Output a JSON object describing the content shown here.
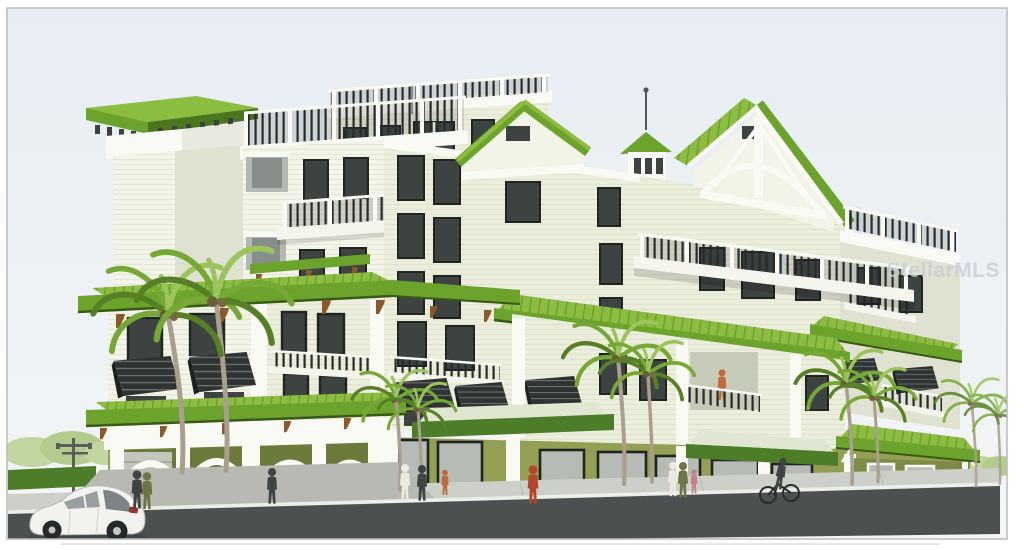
{
  "meta": {
    "type": "architectural-rendering",
    "subject": "Multi-story coastal condominium building with green metal roofs, cream siding and olive-green ground floor",
    "setting": "Street-corner view with palm trees, pedestrians, a cyclist, parked white hatchback and storefront arcade"
  },
  "watermark": {
    "text": "StellarMLS"
  },
  "palette": {
    "paper": "#ffffff",
    "border": "#b7bbbe",
    "sky_top": "#e7edf3",
    "sky_bottom": "#f4f6f7",
    "roof_light": "#8cbd41",
    "roof_mid": "#6ba32c",
    "roof_dark": "#4c761d",
    "roof_edge": "#3a5a15",
    "wall_cream": "#f3f4e8",
    "wall_cream2": "#eceedc",
    "wall_shade": "#dfe2d0",
    "trim_white": "#fafaf4",
    "olive": "#93a054",
    "olive_shade": "#7d8b46",
    "olive_dark": "#6c7a3c",
    "glass": "#3d4341",
    "glass_light": "#b7bbb5",
    "frame": "#202522",
    "rail_dark": "#272b2a",
    "slab": "#f5f5ee",
    "bracket": "#8a5a2a",
    "trunk": "#a89f8d",
    "frond": "#76a836",
    "frond_dark": "#577f26",
    "frond_light": "#9cc45d",
    "bed": "#5c8530",
    "flower": "#ddb043",
    "hedge": "#4e7d2a",
    "bgtree": "#c2d6a0",
    "road": "#4d5051",
    "sidewalk": "#cdd0c8",
    "curb": "#eceee8",
    "drive": "#b7b9b2",
    "car_white": "#f2f2ef",
    "car_shade": "#b9bcb6",
    "car_glass": "#9aa0a2",
    "car_glass_dark": "#7e8486",
    "wheel": "#26292a",
    "hub": "#c5c8c4",
    "tail": "#93342f",
    "blur_car": "#8f9494",
    "canopy_dark": "#4e7d2a",
    "canopy_sheen": "#dfe7d2",
    "watermark": "#c9ced4",
    "fig_red": "#b5452c",
    "fig_olive": "#6d7446",
    "fig_dark": "#3f4440",
    "fig_white": "#eceae2",
    "fig_pink": "#c77f8a",
    "fig_blue": "#dce4ea",
    "fig_orange": "#c06a38",
    "pole": "#5a5d5a"
  },
  "scene": {
    "objects": [
      "sky",
      "elevator-tower",
      "penthouse-roof-deck",
      "center-block",
      "left-gable",
      "cupola",
      "right-gable",
      "roof-terrace",
      "long-balcony",
      "main-green-roof",
      "right-wing",
      "left-wing",
      "ground-arcade",
      "storefronts",
      "pavilion",
      "palm-trees",
      "landscaping",
      "street-light",
      "sidewalk",
      "road",
      "white-hatchback-car",
      "parked-gray-cars",
      "pedestrians",
      "cyclist",
      "watermark"
    ]
  }
}
